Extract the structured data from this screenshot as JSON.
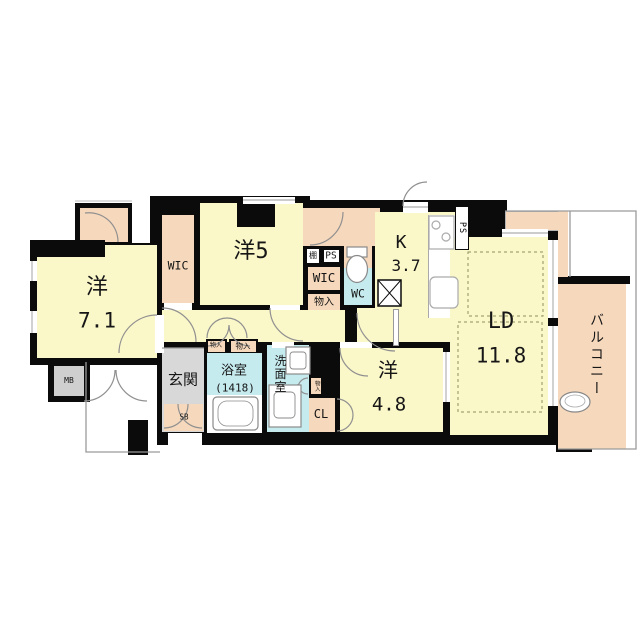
{
  "title": "apartment-floor-plan",
  "labels": {
    "bedroom1_name": "洋",
    "bedroom1_size": "7.1",
    "bedroom2_name": "洋5",
    "bedroom3_name": "洋",
    "bedroom3_size": "4.8",
    "kitchen_name": "K",
    "kitchen_size": "3.7",
    "living_name": "LD",
    "living_size": "11.8",
    "balcony": "バルコニー",
    "entrance": "玄関",
    "bath": "浴室",
    "bath_size": "(1418)",
    "washroom": "洗面室",
    "toilet": "WC",
    "wic_left": "WIC",
    "wic_center": "WIC",
    "closet": "CL",
    "storage_center": "物入",
    "storage_hall_small": "物入",
    "storage_hall": "物入",
    "storage_wash": "物入",
    "shelf": "棚",
    "shoe_box": "SB",
    "meter_box": "MB",
    "pipe_space_center": "PS",
    "pipe_space_kitchen": "PS"
  },
  "colors": {
    "wall": "#0b0b0b",
    "room_yellow": "#faf7c9",
    "storage_peach": "#f6d8bc",
    "wet_cyan": "#c6ebef",
    "entrance_gray": "#d8d8d8",
    "line_gray": "#909090"
  }
}
